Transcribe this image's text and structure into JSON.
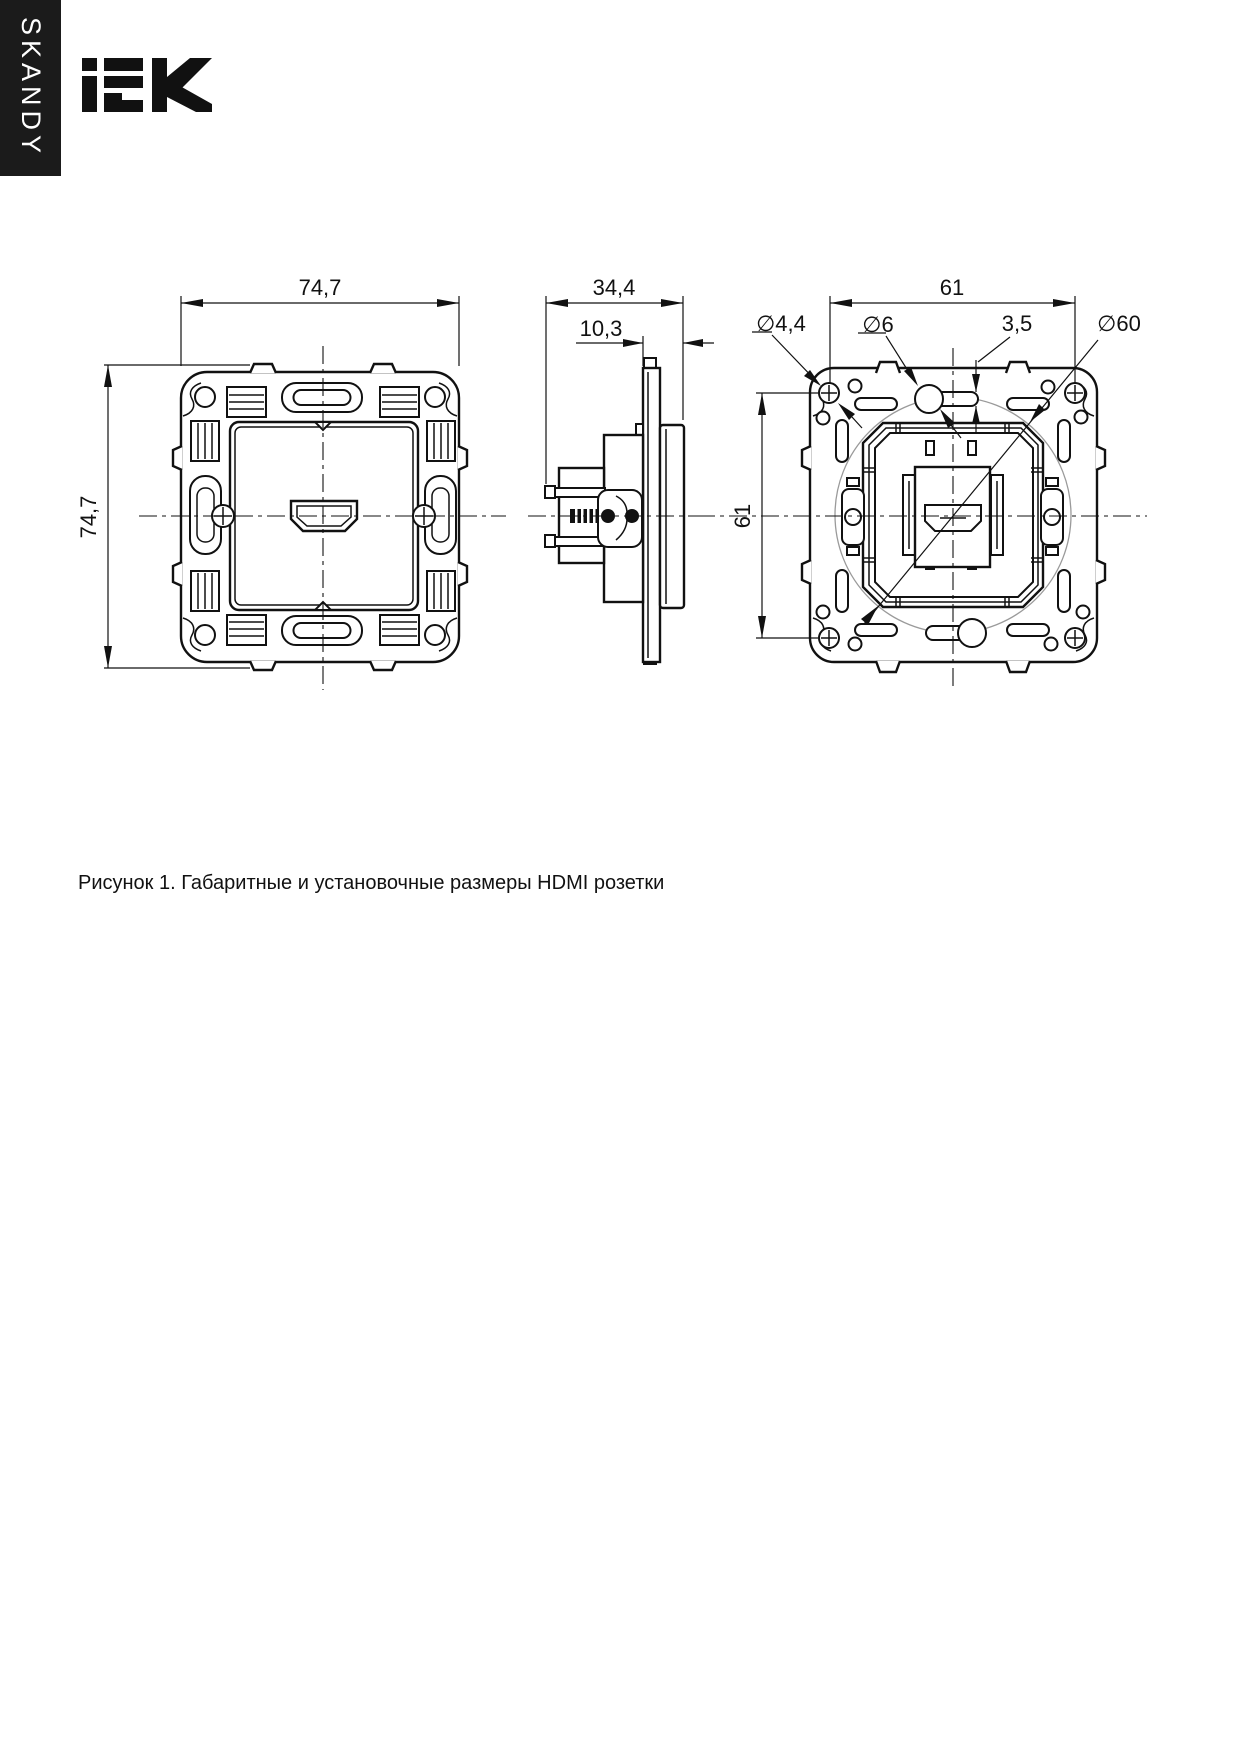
{
  "page": {
    "width_px": 1239,
    "height_px": 1746,
    "background": "#ffffff",
    "line_color": "#111111"
  },
  "sidebar": {
    "series_label": "SKANDY",
    "bg": "#1b1b1b",
    "text_color": "#ffffff"
  },
  "logo": {
    "brand": "IEK",
    "color": "#1b1b1b"
  },
  "figure": {
    "caption": "Рисунок 1. Габаритные и установочные размеры HDMI розетки",
    "subject": "HDMI розетка",
    "views": {
      "front": {
        "title": "front-view",
        "dim_width": "74,7",
        "dim_height": "74,7"
      },
      "side": {
        "title": "side-view",
        "dim_depth": "34,4",
        "dim_front_offset": "10,3"
      },
      "back": {
        "title": "back-view",
        "dim_mount_spacing_h": "61",
        "dim_mount_spacing_v": "61",
        "dim_screw_hole_dia": "∅4,4",
        "dim_hole_dia": "∅6",
        "dim_slot_width": "3,5",
        "dim_mount_circle_dia": "∅60"
      }
    }
  }
}
